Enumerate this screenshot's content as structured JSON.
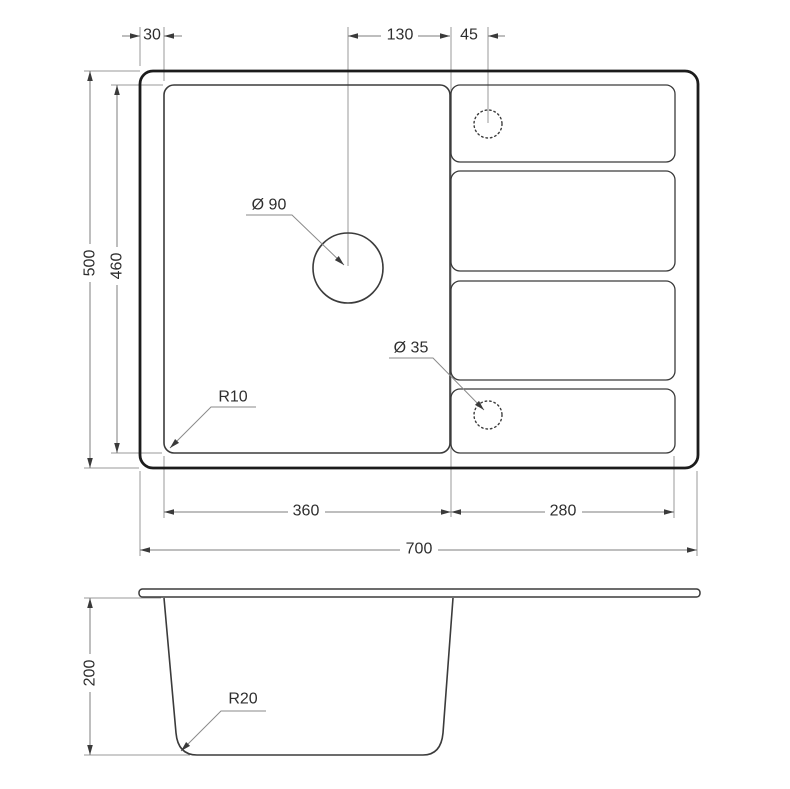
{
  "drawing": {
    "type": "technical-drawing",
    "subject": "inset kitchen sink with single bowl and drainboard",
    "views": [
      "top-view",
      "front-section-view"
    ],
    "colors": {
      "outline": "#1c1c1c",
      "feature_line": "#3b3b3b",
      "dimension_line": "#7d7d7d",
      "extension_line": "#9a9a9a",
      "text": "#2e2e2e",
      "background": "#ffffff"
    }
  },
  "labels": {
    "offset_30": "30",
    "drain_130": "130",
    "faucet_45": "45",
    "height_500": "500",
    "bowl_460": "460",
    "bowl_360": "360",
    "drainboard_280": "280",
    "width_700": "700",
    "depth_200": "200",
    "drain_dia": "Ø 90",
    "hole_dia": "Ø 35",
    "radius_r10": "R10",
    "radius_r20": "R20"
  }
}
